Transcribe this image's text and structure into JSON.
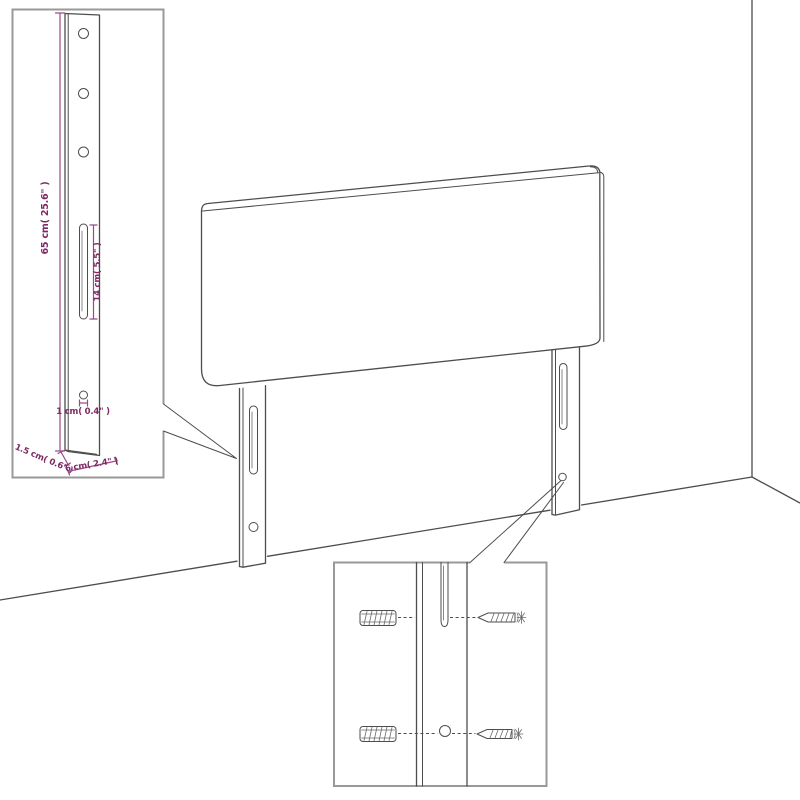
{
  "diagram": {
    "title": "headboard-wall-mount-dimension-diagram",
    "subject": "upholstered headboard with two mounting legs shown against a wall corner",
    "colors": {
      "background": "#ffffff",
      "drawing_line": "#4d4d4d",
      "inset_border": "#999999",
      "dimension_line": "#9a4a8b",
      "dimension_text": "#7d2963"
    },
    "labels": {
      "leg_height": "65 cm( 25.6\" )",
      "slot_length": "14 cm( 5.5\" )",
      "hole_diameter": "1 cm( 0.4\" )",
      "leg_thickness": "1.5 cm( 0.6\" )",
      "leg_width": "6 cm( 2.4\" )"
    },
    "insets": {
      "top_left": "enlarged mounting leg with 3 holes, long slot, bottom hole and outer dimensions",
      "bottom_center": "close-up of leg slot and hole with wall plugs and screws alignment"
    }
  }
}
